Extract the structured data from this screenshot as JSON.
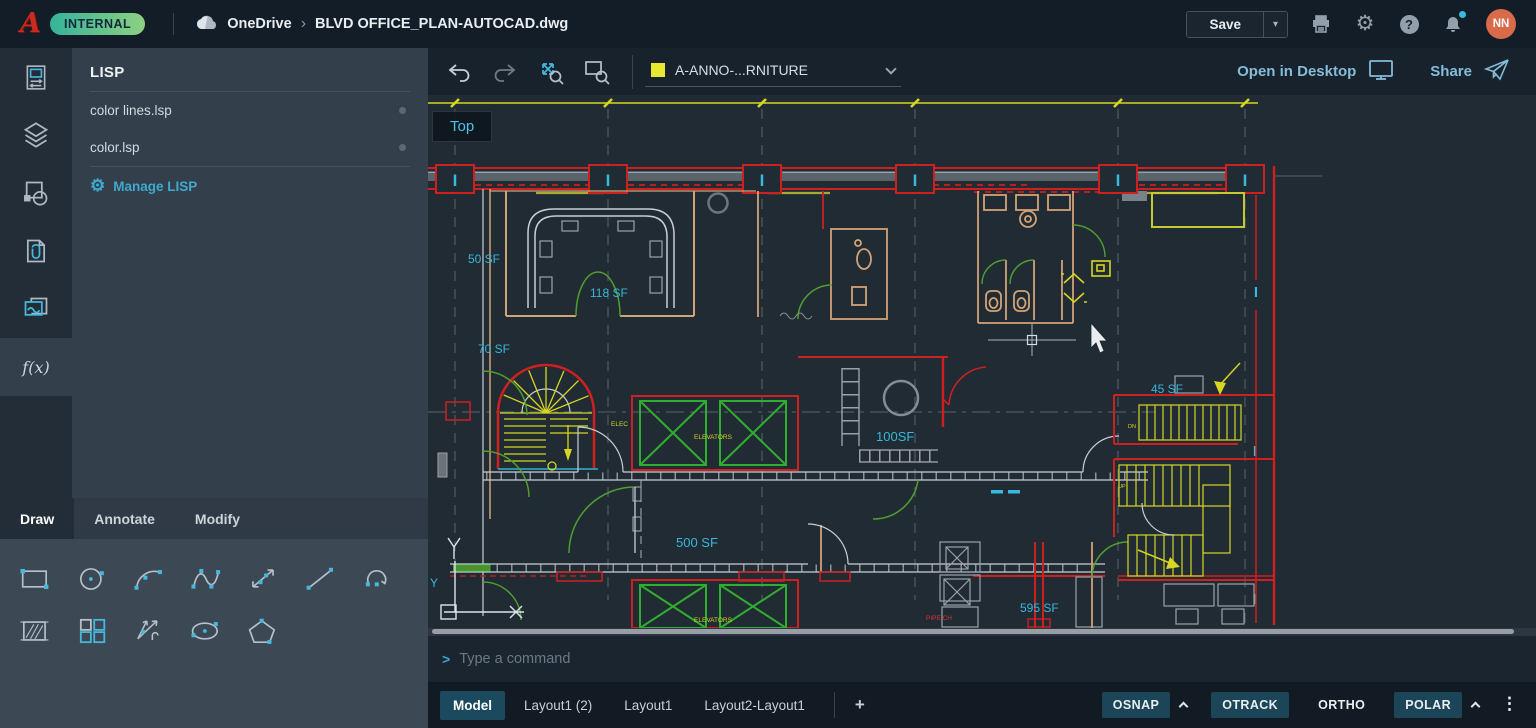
{
  "topbar": {
    "product_badge": "INTERNAL",
    "breadcrumb": {
      "provider": "OneDrive",
      "separator": "›",
      "file": "BLVD OFFICE_PLAN-AUTOCAD.dwg"
    },
    "save_label": "Save",
    "avatar_initials": "NN"
  },
  "rail": {
    "tools": [
      "drawing",
      "layers",
      "blocks",
      "xrefs",
      "images",
      "lisp"
    ],
    "fx_label": "f(x)"
  },
  "lisp_panel": {
    "title": "LISP",
    "items": [
      {
        "label": "color lines.lsp"
      },
      {
        "label": "color.lsp"
      }
    ],
    "manage_label": "Manage LISP"
  },
  "tool_panel": {
    "tabs": [
      {
        "label": "Draw"
      },
      {
        "label": "Annotate"
      },
      {
        "label": "Modify"
      }
    ],
    "row1_tools": [
      "rectangle",
      "circle",
      "arc",
      "spline",
      "construction-line",
      "line",
      "start-arc"
    ],
    "row2_tools": [
      "hatch",
      "array",
      "ray",
      "ellipse",
      "polygon"
    ]
  },
  "canvas_toolbar": {
    "layer_name": "A-ANNO-...RNITURE",
    "layer_swatch": "#e8e832",
    "open_in_desktop": "Open in Desktop",
    "share": "Share"
  },
  "viewport": {
    "view": "Top",
    "labels": {
      "sf50": "50 SF",
      "sf118": "118 SF",
      "sf70": "70 SF",
      "sf100": "100SF",
      "sf45": "45 SF",
      "sf500": "500 SF",
      "sf595": "595 SF",
      "elevators": "ELEVATORS",
      "elec": "ELEC",
      "dn": "DN",
      "up": "UP",
      "pipe_chase": "PIPE CH",
      "ucs_y": "Y"
    }
  },
  "command_bar": {
    "prompt": ">",
    "placeholder": "Type a command"
  },
  "layout_tabs": {
    "tabs": [
      {
        "label": "Model"
      },
      {
        "label": "Layout1 (2)"
      },
      {
        "label": "Layout1"
      },
      {
        "label": "Layout2-Layout1"
      }
    ],
    "add": "+"
  },
  "status_bar": {
    "toggles": [
      {
        "label": "OSNAP"
      },
      {
        "label": "OTRACK"
      },
      {
        "label": "ORTHO"
      },
      {
        "label": "POLAR"
      }
    ]
  },
  "colors": {
    "accent": "#46b8dc",
    "wall_red": "#cf2020",
    "anno_yellow": "#d6d623",
    "elevator_green": "#2fae2f",
    "interior_tan": "#d2a377",
    "label_cyan": "#38b7da",
    "toggle_active": "#1d4558",
    "avatar": "#d96a4a"
  }
}
